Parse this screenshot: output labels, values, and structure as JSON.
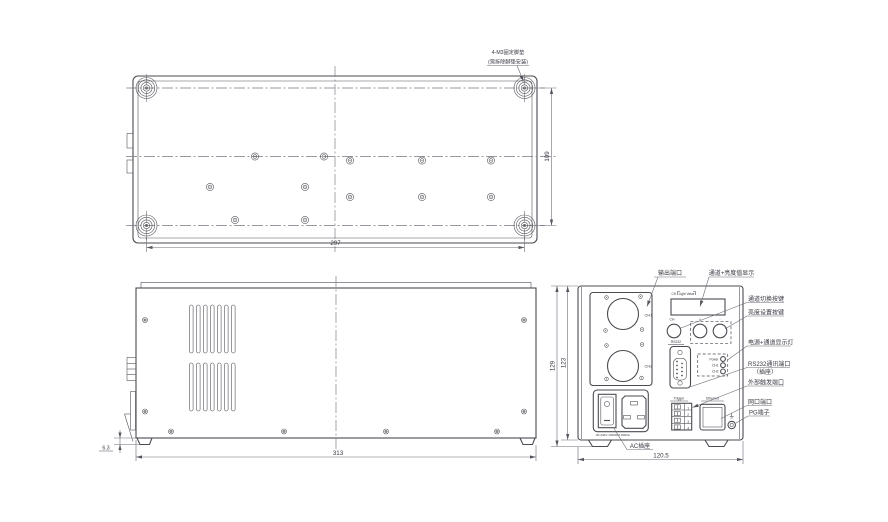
{
  "drawing": {
    "note_line1": "4-M3固定脚垫",
    "note_line2": "(需拆除脚垫安装)",
    "dim_top_width": "297",
    "dim_top_depth": "109",
    "dim_side_width": "313",
    "dim_foot_height": "6.3",
    "dim_rear_height_outer": "129",
    "dim_rear_height_body": "123",
    "dim_rear_width": "120.5",
    "panel": {
      "ch1": "CH1",
      "ch2": "CH2",
      "display_ch_label": "CH",
      "display_value_label": "Light Value",
      "btn_ch_label": "CH",
      "btn_up_label": "+",
      "btn_down_label": "-",
      "rs232_label": "RS232",
      "led_power": "Power",
      "led_ch1": "CH1",
      "led_ch2": "CH2",
      "trigger_label": "Trigger",
      "trigger_pins": [
        "1",
        "2",
        "3",
        "4"
      ],
      "ethernet_label": "Ethernet",
      "rating": "90-240V~50/60Hz 800VA"
    },
    "callouts": {
      "output_port": "输出端口",
      "display": "通道+亮度值显示",
      "channel_switch": "通道切换按键",
      "brightness_set": "亮度设置按键",
      "power_channel_leds": "电源+通道显示灯",
      "rs232_port": "RS232通讯端口",
      "rs232_port_sub": "（插座）",
      "external_trigger": "外部触发端口",
      "lan_port": "网口端口",
      "pg_terminal": "PG端子",
      "ac_socket": "AC插座"
    }
  }
}
